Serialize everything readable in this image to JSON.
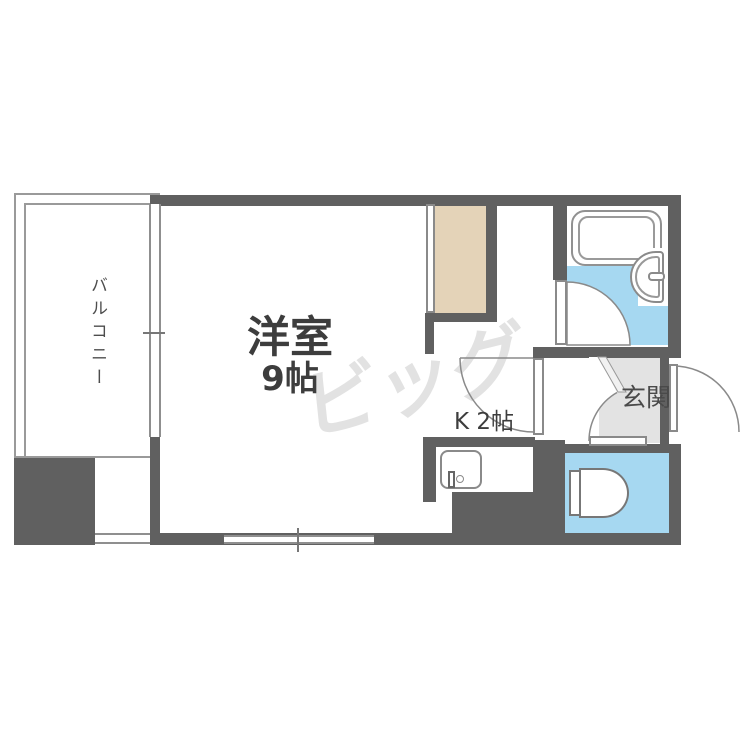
{
  "rooms": {
    "balcony": {
      "label": "バルコニー"
    },
    "living": {
      "name": "洋室",
      "size": "9帖"
    },
    "kitchen": {
      "label": "K 2帖"
    },
    "entrance": {
      "label": "玄関"
    }
  },
  "watermark": {
    "text": "ビッグ"
  },
  "fixtures": [
    "bathtub",
    "wash-basin",
    "toilet",
    "kitchen-sink",
    "closet"
  ],
  "colors": {
    "wall": "#606060",
    "water_area": "#a6d8f1",
    "closet": "#e4d3b8",
    "entrance_floor": "#e3e3e3",
    "fixture_line": "#8a8a8a",
    "label_text": "#3d3d3d",
    "watermark": "#e2e2e2"
  }
}
